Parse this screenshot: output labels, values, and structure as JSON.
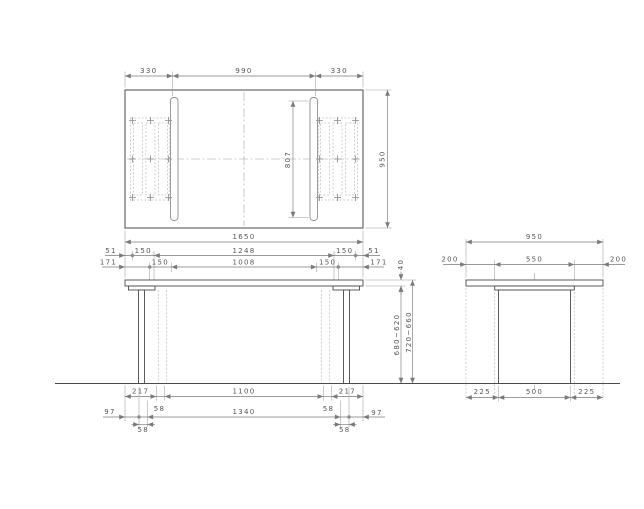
{
  "meta": {
    "description": "Three-view technical drawing of a table (plan, front elevation, side elevation)"
  },
  "colors": {
    "outline": "#4a4a4a",
    "dimension_lines": "#7a7a7a",
    "hidden_lines": "#bcbcbc",
    "text": "#555555",
    "background": "#ffffff"
  },
  "top_view": {
    "dim_left_overhang": "330",
    "dim_center_span": "990",
    "dim_right_overhang": "330",
    "dim_total_width": "1650",
    "dim_depth": "950",
    "dim_leg_length": "807"
  },
  "front_view": {
    "row1": [
      "51",
      "150",
      "1248",
      "150",
      "51"
    ],
    "row2": [
      "171",
      "150",
      "1008",
      "150",
      "171"
    ],
    "top_thickness": "40",
    "height_under_top": "680~620",
    "height_overall": "720~660",
    "bottom_row1": [
      "217",
      "1100",
      "217"
    ],
    "bottom_row2": [
      "97",
      "58",
      "1340",
      "58",
      "97"
    ],
    "bottom_row3": [
      "58",
      "58"
    ]
  },
  "side_view": {
    "dim_total_depth": "950",
    "top_row": [
      "200",
      "550",
      "200"
    ],
    "bottom_row": [
      "225",
      "500",
      "225"
    ]
  }
}
